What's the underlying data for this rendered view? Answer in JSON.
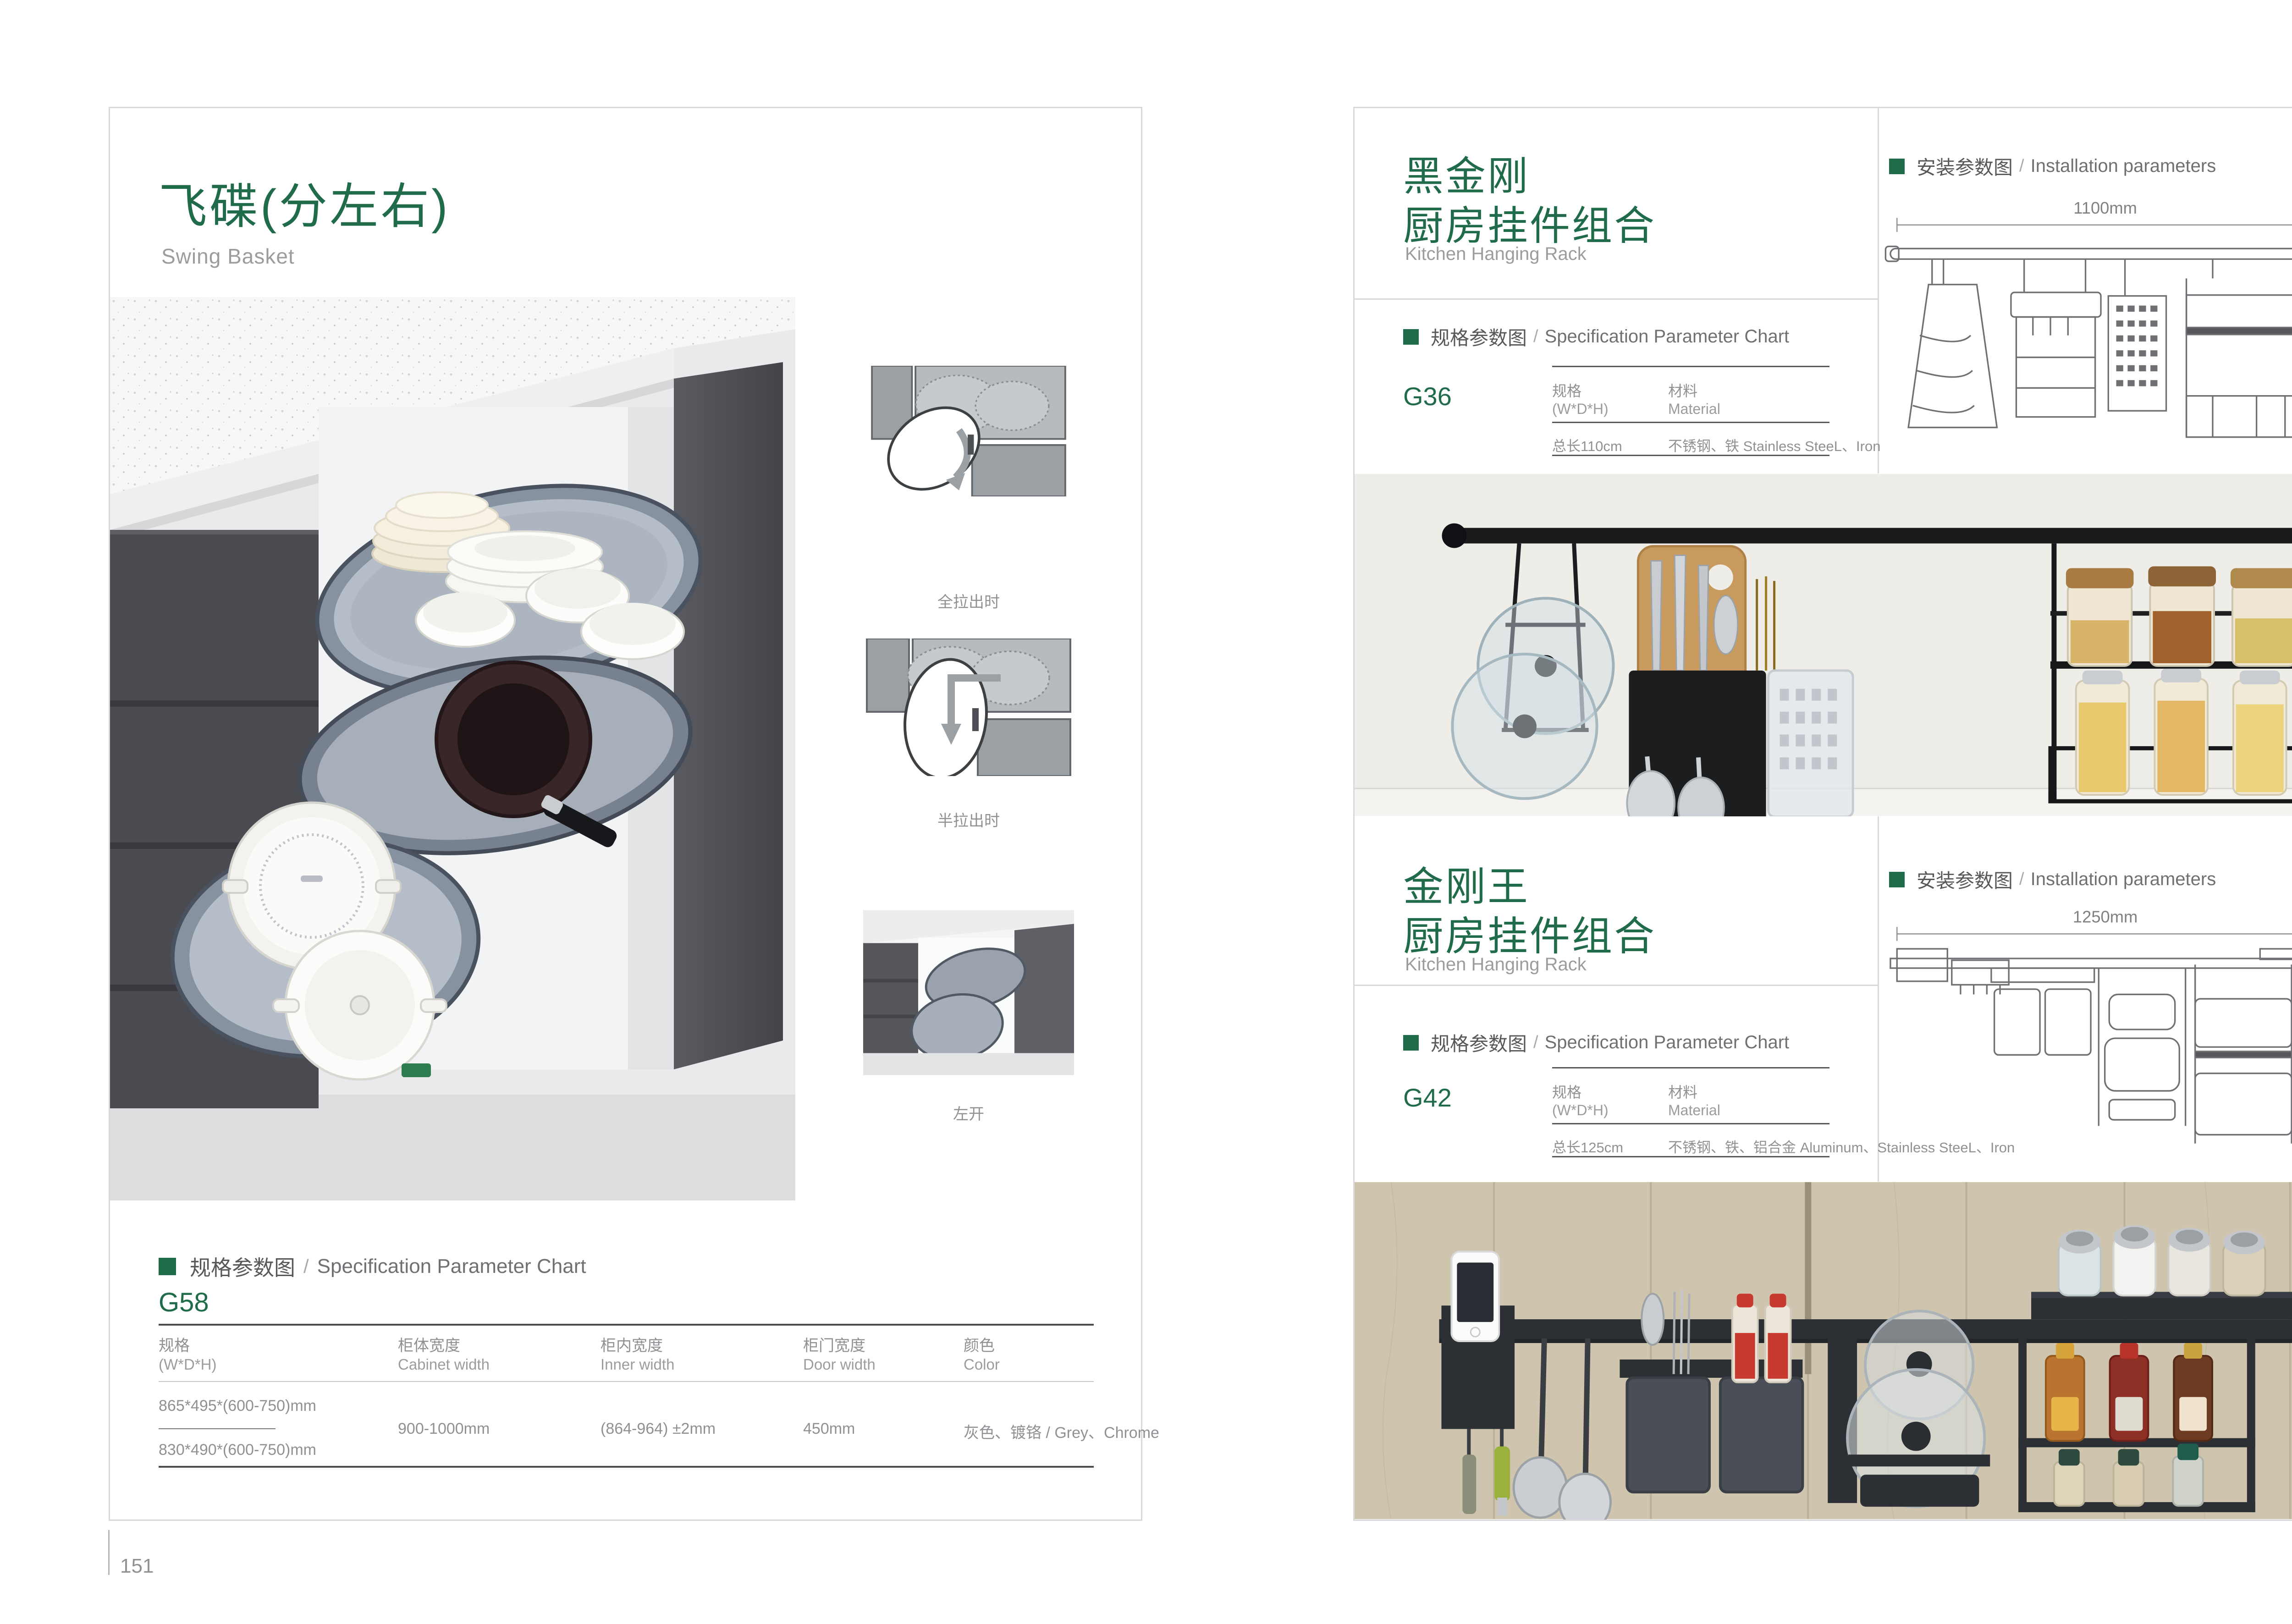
{
  "colors": {
    "accent_green": "#1f6b4a",
    "page_border": "#d9d9d9"
  },
  "page_left": {
    "page_number": "151",
    "title_zh": "飞碟(分左右)",
    "title_en": "Swing Basket",
    "diagram_labels": [
      "全拉出时",
      "半拉出时",
      "左开"
    ],
    "spec_heading": {
      "zh": "规格参数图",
      "sep": "/",
      "en": "Specification Parameter Chart"
    },
    "model": "G58",
    "table": {
      "columns": [
        {
          "zh": "规格",
          "en": "(W*D*H)"
        },
        {
          "zh": "柜体宽度",
          "en": "Cabinet width"
        },
        {
          "zh": "柜内宽度",
          "en": "Inner width"
        },
        {
          "zh": "柜门宽度",
          "en": "Door width"
        },
        {
          "zh": "颜色",
          "en": "Color"
        }
      ],
      "spec_row_1": "865*495*(600-750)mm",
      "spec_row_2": "830*490*(600-750)mm",
      "cabinet_width": "900-1000mm",
      "inner_width": "(864-964) ±2mm",
      "door_width": "450mm",
      "color": "灰色、镀铬 / Grey、Chrome"
    }
  },
  "page_right": {
    "page_number": "152",
    "spec_heading": {
      "zh": "规格参数图",
      "sep": "/",
      "en": "Specification Parameter Chart"
    },
    "install_heading": {
      "zh": "安装参数图",
      "sep": "/",
      "en": "Installation parameters"
    },
    "sections": [
      {
        "title_zh_1": "黑金刚",
        "title_zh_2": "厨房挂件组合",
        "title_en": "Kitchen Hanging Rack",
        "model": "G36",
        "table": {
          "col1_zh": "规格",
          "col1_en": "(W*D*H)",
          "col2_zh": "材料",
          "col2_en": "Material",
          "value1": "总长110cm",
          "value2": "不锈钢、铁  Stainless SteeL、Iron"
        },
        "dims": {
          "width": "1100mm",
          "height": "420mm"
        }
      },
      {
        "title_zh_1": "金刚王",
        "title_zh_2": "厨房挂件组合",
        "title_en": "Kitchen Hanging Rack",
        "model": "G42",
        "table": {
          "col1_zh": "规格",
          "col1_en": "(W*D*H)",
          "col2_zh": "材料",
          "col2_en": "Material",
          "value1": "总长125cm",
          "value2": "不锈钢、铁、铝合金  Aluminum、Stainless SteeL、Iron"
        },
        "dims": {
          "width": "1250mm",
          "height": "430mm"
        }
      }
    ]
  }
}
